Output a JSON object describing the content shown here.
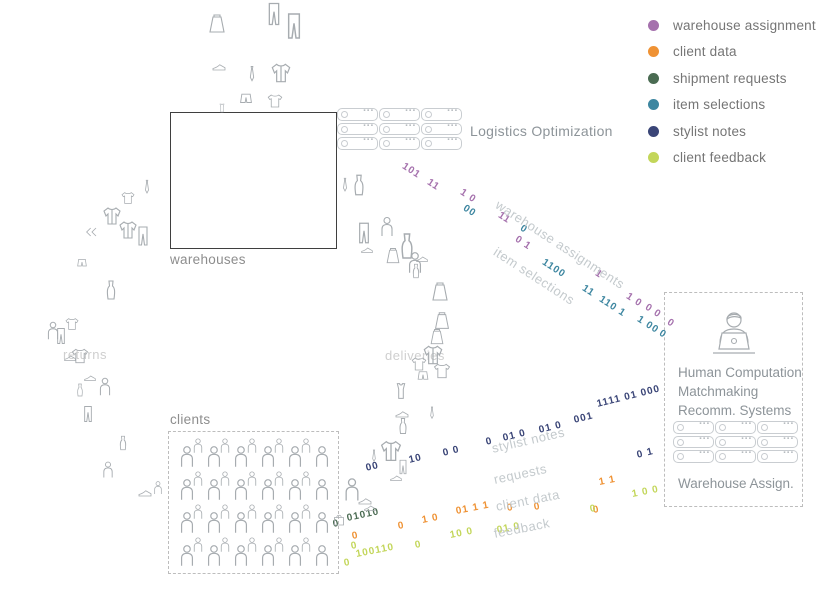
{
  "legend": {
    "items": [
      {
        "label": "warehouse assignment",
        "color": "#a571ad"
      },
      {
        "label": "client data",
        "color": "#ef9234"
      },
      {
        "label": "shipment requests",
        "color": "#4a6b52"
      },
      {
        "label": "item selections",
        "color": "#3d86a0"
      },
      {
        "label": "stylist notes",
        "color": "#3a4577"
      },
      {
        "label": "client feedback",
        "color": "#c3d65a"
      }
    ]
  },
  "zones": {
    "warehouses_label": "warehouses",
    "clients_label": "clients"
  },
  "logistics": {
    "label": "Logistics Optimization",
    "servers": {
      "rows": 3,
      "cols": 3
    }
  },
  "panel": {
    "title_lines": [
      "Human Computation",
      "Matchmaking",
      "Recomm. Systems"
    ],
    "subtitle": "Warehouse Assign.",
    "servers": {
      "rows": 3,
      "cols": 3
    }
  },
  "crowd": {
    "rows": 4,
    "big_per_row": 6,
    "small_per_row": 5
  },
  "flow_labels": [
    {
      "name": "warehouse-assignments-label",
      "text": "warehouse assignments",
      "x": 497,
      "y": 196,
      "rot": 33
    },
    {
      "name": "item-selections-label",
      "text": "item selections",
      "x": 495,
      "y": 243,
      "rot": 33
    },
    {
      "name": "stylist-notes-label",
      "text": "stylist notes",
      "x": 492,
      "y": 441,
      "rot": -13
    },
    {
      "name": "requests-label",
      "text": "requests",
      "x": 494,
      "y": 472,
      "rot": -12
    },
    {
      "name": "client-data-label",
      "text": "client data",
      "x": 496,
      "y": 499,
      "rot": -11
    },
    {
      "name": "feedback-label",
      "text": "feedback",
      "x": 494,
      "y": 526,
      "rot": -11
    },
    {
      "name": "deliveries-label",
      "text": "deliveries",
      "x": 385,
      "y": 348,
      "rot": 0,
      "plain": true
    },
    {
      "name": "returns-label",
      "text": "returns",
      "x": 63,
      "y": 347,
      "rot": 0,
      "plain": true
    }
  ],
  "streams": [
    {
      "name": "warehouse-assignments",
      "color": "#a571ad",
      "rot": 33,
      "groups": [
        {
          "t": "101",
          "x": 403,
          "y": 160
        },
        {
          "t": "11",
          "x": 428,
          "y": 176
        },
        {
          "t": "1 0",
          "x": 461,
          "y": 186
        },
        {
          "t": "11",
          "x": 499,
          "y": 209
        },
        {
          "t": "0 1",
          "x": 516,
          "y": 233
        },
        {
          "t": "1",
          "x": 596,
          "y": 267
        },
        {
          "t": "1 0",
          "x": 627,
          "y": 290
        },
        {
          "t": "0 0",
          "x": 646,
          "y": 301
        },
        {
          "t": "0",
          "x": 668,
          "y": 316
        }
      ]
    },
    {
      "name": "item-selections",
      "color": "#3d86a0",
      "rot": 33,
      "groups": [
        {
          "t": "00",
          "x": 464,
          "y": 202
        },
        {
          "t": "0",
          "x": 521,
          "y": 222
        },
        {
          "t": "1100",
          "x": 543,
          "y": 256
        },
        {
          "t": "11",
          "x": 583,
          "y": 282
        },
        {
          "t": "110 1",
          "x": 600,
          "y": 293
        },
        {
          "t": "1 00",
          "x": 638,
          "y": 313
        },
        {
          "t": "0",
          "x": 660,
          "y": 327
        }
      ]
    },
    {
      "name": "stylist-notes",
      "color": "#3a4577",
      "rot": -14,
      "groups": [
        {
          "t": "00",
          "x": 366,
          "y": 463
        },
        {
          "t": "10",
          "x": 409,
          "y": 455
        },
        {
          "t": "0 0",
          "x": 443,
          "y": 448
        },
        {
          "t": "0",
          "x": 486,
          "y": 437
        },
        {
          "t": "01 0",
          "x": 503,
          "y": 433
        },
        {
          "t": "01 0",
          "x": 539,
          "y": 425
        },
        {
          "t": "001",
          "x": 574,
          "y": 415
        },
        {
          "t": "1111 01 000",
          "x": 597,
          "y": 399
        },
        {
          "t": "0 1",
          "x": 637,
          "y": 450
        }
      ]
    },
    {
      "name": "shipment-requests",
      "color": "#4a6b52",
      "rot": -12,
      "groups": [
        {
          "t": "0",
          "x": 333,
          "y": 519
        },
        {
          "t": "01010",
          "x": 347,
          "y": 513
        }
      ]
    },
    {
      "name": "client-data",
      "color": "#ef9234",
      "rot": -11,
      "groups": [
        {
          "t": "0",
          "x": 352,
          "y": 531
        },
        {
          "t": "0",
          "x": 398,
          "y": 521
        },
        {
          "t": "1 0",
          "x": 422,
          "y": 515
        },
        {
          "t": "01 1 1",
          "x": 456,
          "y": 506
        },
        {
          "t": "0",
          "x": 507,
          "y": 503
        },
        {
          "t": "0",
          "x": 534,
          "y": 502
        },
        {
          "t": "0",
          "x": 593,
          "y": 505
        },
        {
          "t": "1 1",
          "x": 599,
          "y": 477
        }
      ]
    },
    {
      "name": "client-feedback",
      "color": "#c3d65a",
      "rot": -11,
      "groups": [
        {
          "t": "0",
          "x": 344,
          "y": 558
        },
        {
          "t": "0",
          "x": 351,
          "y": 541
        },
        {
          "t": "100110",
          "x": 356,
          "y": 549
        },
        {
          "t": "0",
          "x": 415,
          "y": 540
        },
        {
          "t": "10 0",
          "x": 450,
          "y": 530
        },
        {
          "t": "01 0",
          "x": 497,
          "y": 525
        },
        {
          "t": "0",
          "x": 590,
          "y": 504
        },
        {
          "t": "1 0 0",
          "x": 632,
          "y": 489
        }
      ]
    }
  ],
  "icons": [
    {
      "t": "skirt",
      "x": 205,
      "y": 12,
      "s": 24
    },
    {
      "t": "pants",
      "x": 260,
      "y": 0,
      "s": 28
    },
    {
      "t": "pants",
      "x": 278,
      "y": 10,
      "s": 32
    },
    {
      "t": "shoe",
      "x": 210,
      "y": 58,
      "s": 18
    },
    {
      "t": "tie",
      "x": 242,
      "y": 64,
      "s": 20
    },
    {
      "t": "jacket",
      "x": 268,
      "y": 60,
      "s": 26
    },
    {
      "t": "shorts",
      "x": 236,
      "y": 90,
      "s": 20
    },
    {
      "t": "tshirt",
      "x": 266,
      "y": 92,
      "s": 18
    },
    {
      "t": "tank",
      "x": 216,
      "y": 102,
      "s": 12
    },
    {
      "t": "tie",
      "x": 336,
      "y": 176,
      "s": 18
    },
    {
      "t": "dress",
      "x": 346,
      "y": 172,
      "s": 26
    },
    {
      "t": "pants",
      "x": 351,
      "y": 220,
      "s": 26
    },
    {
      "t": "person",
      "x": 375,
      "y": 215,
      "s": 24
    },
    {
      "t": "shoe",
      "x": 359,
      "y": 242,
      "s": 16
    },
    {
      "t": "dress",
      "x": 391,
      "y": 230,
      "s": 32
    },
    {
      "t": "skirt",
      "x": 383,
      "y": 246,
      "s": 20
    },
    {
      "t": "person",
      "x": 402,
      "y": 250,
      "s": 26
    },
    {
      "t": "shoe",
      "x": 414,
      "y": 251,
      "s": 16
    },
    {
      "t": "dress",
      "x": 407,
      "y": 262,
      "s": 18
    },
    {
      "t": "skirt",
      "x": 428,
      "y": 280,
      "s": 24
    },
    {
      "t": "skirt",
      "x": 431,
      "y": 310,
      "s": 22
    },
    {
      "t": "skirt",
      "x": 427,
      "y": 327,
      "s": 20
    },
    {
      "t": "jacket",
      "x": 420,
      "y": 342,
      "s": 26
    },
    {
      "t": "tshirt",
      "x": 410,
      "y": 355,
      "s": 18
    },
    {
      "t": "tshirt",
      "x": 432,
      "y": 361,
      "s": 20
    },
    {
      "t": "shorts",
      "x": 414,
      "y": 368,
      "s": 18
    },
    {
      "t": "tank",
      "x": 390,
      "y": 380,
      "s": 22
    },
    {
      "t": "shoe",
      "x": 393,
      "y": 405,
      "s": 18
    },
    {
      "t": "tie",
      "x": 424,
      "y": 405,
      "s": 16
    },
    {
      "t": "dress",
      "x": 393,
      "y": 416,
      "s": 20
    },
    {
      "t": "tie",
      "x": 366,
      "y": 448,
      "s": 16
    },
    {
      "t": "jacket",
      "x": 377,
      "y": 437,
      "s": 28
    },
    {
      "t": "pants",
      "x": 394,
      "y": 458,
      "s": 18
    },
    {
      "t": "shoe",
      "x": 388,
      "y": 470,
      "s": 16
    },
    {
      "t": "person",
      "x": 338,
      "y": 476,
      "s": 28
    },
    {
      "t": "shoe",
      "x": 356,
      "y": 492,
      "s": 18
    },
    {
      "t": "shoe",
      "x": 362,
      "y": 500,
      "s": 16
    },
    {
      "t": "bag",
      "x": 330,
      "y": 510,
      "s": 18
    },
    {
      "t": "tie",
      "x": 138,
      "y": 178,
      "s": 18
    },
    {
      "t": "tshirt",
      "x": 120,
      "y": 190,
      "s": 16
    },
    {
      "t": "jacket",
      "x": 100,
      "y": 204,
      "s": 24
    },
    {
      "t": "jacket",
      "x": 116,
      "y": 218,
      "s": 24
    },
    {
      "t": "pants",
      "x": 131,
      "y": 224,
      "s": 24
    },
    {
      "t": "chevrons",
      "x": 84,
      "y": 224,
      "s": 16
    },
    {
      "t": "shorts",
      "x": 74,
      "y": 256,
      "s": 16
    },
    {
      "t": "dress",
      "x": 99,
      "y": 278,
      "s": 24
    },
    {
      "t": "person",
      "x": 42,
      "y": 320,
      "s": 22
    },
    {
      "t": "tshirt",
      "x": 64,
      "y": 316,
      "s": 16
    },
    {
      "t": "pants",
      "x": 51,
      "y": 326,
      "s": 20
    },
    {
      "t": "tshirt",
      "x": 70,
      "y": 346,
      "s": 20
    },
    {
      "t": "shoe",
      "x": 62,
      "y": 350,
      "s": 16
    },
    {
      "t": "shoe",
      "x": 82,
      "y": 370,
      "s": 16
    },
    {
      "t": "person",
      "x": 94,
      "y": 376,
      "s": 22
    },
    {
      "t": "dress",
      "x": 72,
      "y": 382,
      "s": 16
    },
    {
      "t": "pants",
      "x": 78,
      "y": 404,
      "s": 20
    },
    {
      "t": "dress",
      "x": 114,
      "y": 434,
      "s": 18
    },
    {
      "t": "person",
      "x": 98,
      "y": 460,
      "s": 20
    },
    {
      "t": "shoe",
      "x": 136,
      "y": 484,
      "s": 18
    },
    {
      "t": "person",
      "x": 150,
      "y": 480,
      "s": 16
    }
  ]
}
